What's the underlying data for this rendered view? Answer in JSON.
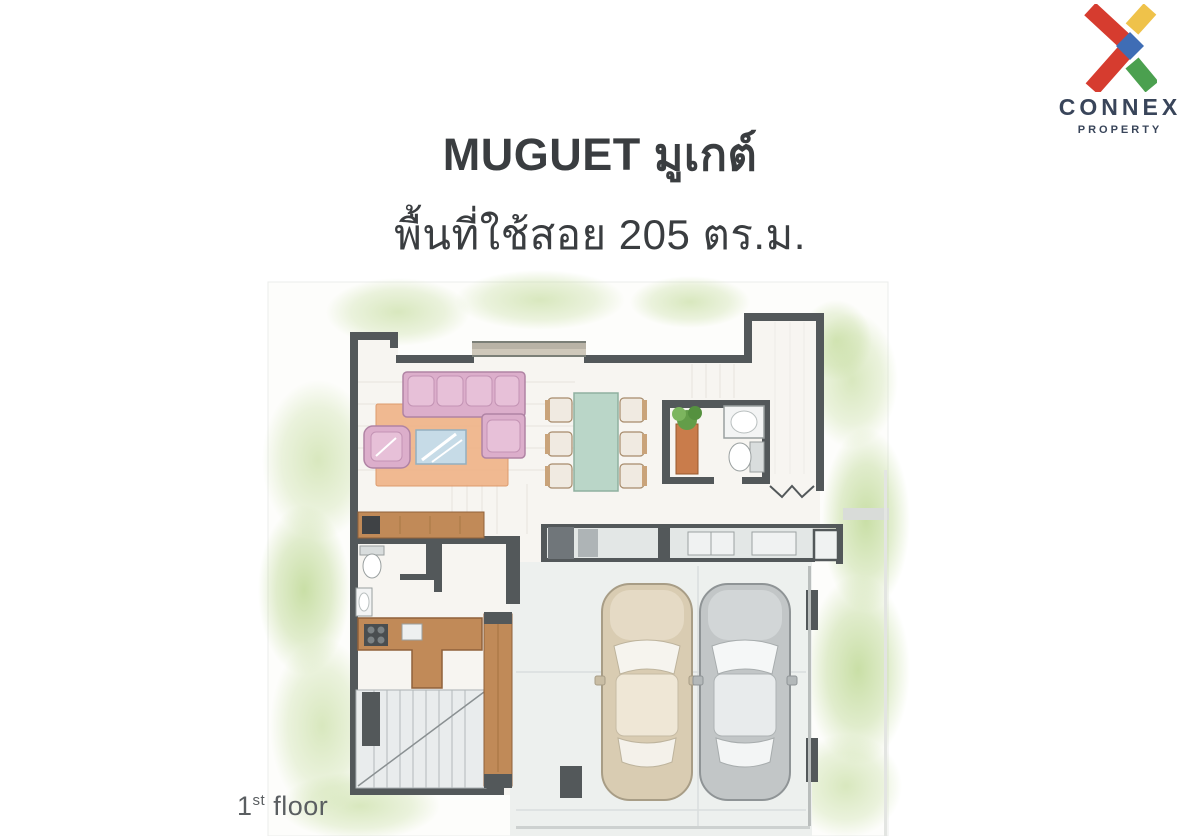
{
  "header": {
    "title": "MUGUET มูเกต์",
    "subtitle": "พื้นที่ใช้สอย 205 ตร.ม."
  },
  "logo": {
    "brand": "CONNEX",
    "tagline": "PROPERTY",
    "colors": {
      "red": "#d63c2f",
      "yellow": "#efc24a",
      "green": "#4ba04f",
      "blue": "#3f6db5",
      "navy": "#39455a"
    }
  },
  "plan": {
    "floor_label": {
      "number": "1",
      "suffix": "st",
      "word": "floor"
    },
    "colors": {
      "wall": "#53585a",
      "rug": "#eeb286",
      "sofa": "#dcaecb",
      "coffee_table": "#c6dbe7",
      "dining_table": "#bad6c8",
      "wood": "#c18a58",
      "watercolor_green": "#bad68c",
      "car_beige": "#d9ccb2",
      "car_gray": "#c2c6c7"
    }
  }
}
